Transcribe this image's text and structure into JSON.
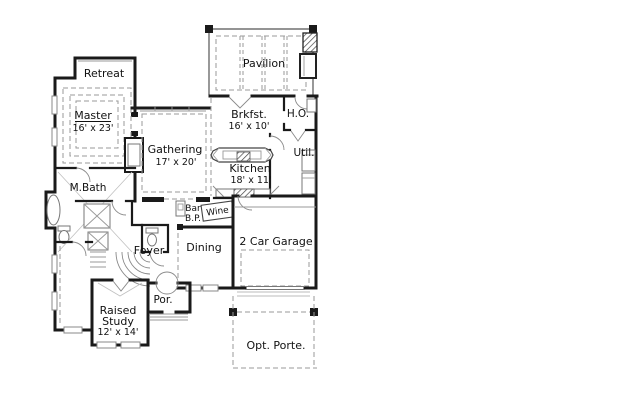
{
  "figure": {
    "kind": "residential-floor-plan"
  },
  "colors": {
    "background": "#ffffff",
    "wall": "#1a1a1a",
    "dashed_line": "#9a9a9a",
    "fixture_line": "#777777",
    "text": "#111111"
  },
  "rooms": {
    "pavilion": {
      "label": "Pavilion"
    },
    "retreat": {
      "label": "Retreat"
    },
    "master": {
      "label": "Master",
      "dims": "16' x 23'"
    },
    "gathering": {
      "label": "Gathering",
      "dims": "17' x 20'"
    },
    "brkfst": {
      "label": "Brkfst.",
      "dims": "16' x 10'"
    },
    "ho": {
      "label": "H.O."
    },
    "util": {
      "label": "Util."
    },
    "kitchen": {
      "label": "Kitchen",
      "dims": "18' x 11'"
    },
    "mbath": {
      "label": "M.Bath"
    },
    "bar": {
      "label": "Bar"
    },
    "bp": {
      "label": "B.P."
    },
    "wine": {
      "label": "Wine"
    },
    "foyer": {
      "label": "Foyer"
    },
    "dining": {
      "label": "Dining"
    },
    "garage": {
      "label": "2 Car Garage"
    },
    "study": {
      "lines": [
        "Raised",
        "Study",
        "12' x 14'"
      ]
    },
    "por": {
      "label": "Por."
    },
    "porte": {
      "label": "Opt. Porte."
    }
  }
}
